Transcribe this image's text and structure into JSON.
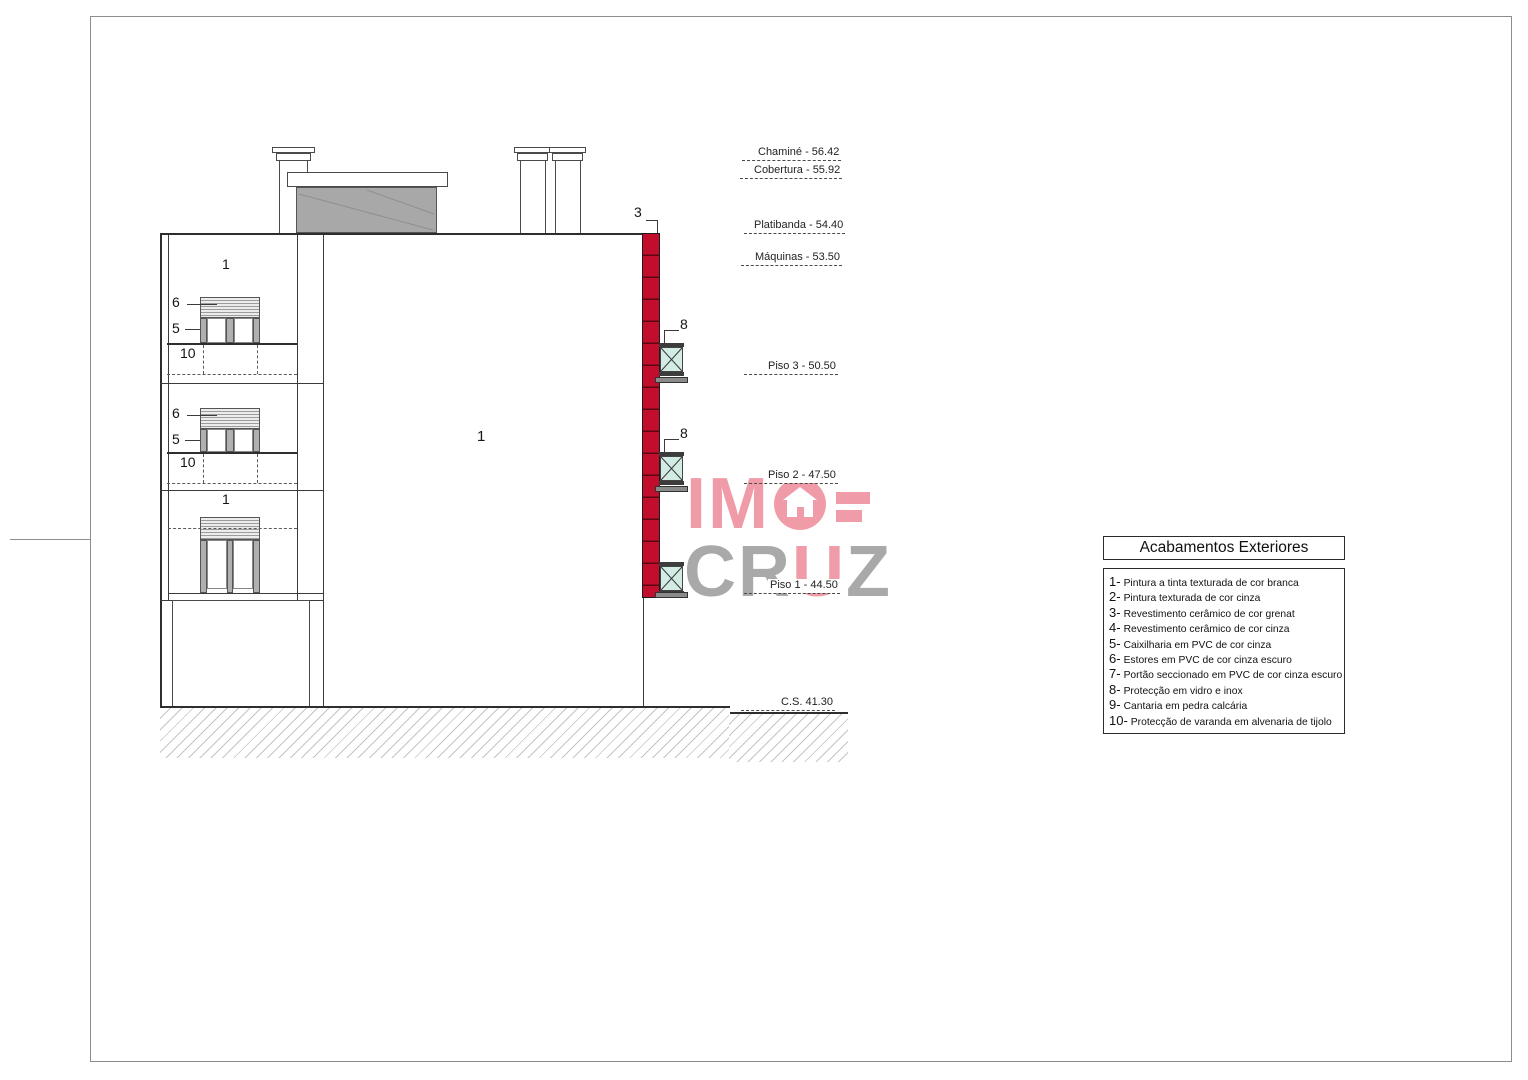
{
  "callouts": {
    "wall_white": "1",
    "ceramic": "3",
    "frame": "5",
    "shutter": "6",
    "glass": "8",
    "parapet": "10"
  },
  "levels": [
    {
      "label": "Chaminé - 56.42"
    },
    {
      "label": "Cobertura - 55.92"
    },
    {
      "label": "Platibanda - 54.40"
    },
    {
      "label": "Máquinas - 53.50"
    },
    {
      "label": "Piso 3 - 50.50"
    },
    {
      "label": "Piso 2 - 47.50"
    },
    {
      "label": "Piso 1 - 44.50"
    },
    {
      "label": "C.S. 41.30"
    }
  ],
  "legend": {
    "title": "Acabamentos Exteriores",
    "items": [
      {
        "num": "1-",
        "text": "Pintura a tinta texturada de cor branca"
      },
      {
        "num": "2-",
        "text": "Pintura texturada de cor cinza"
      },
      {
        "num": "3-",
        "text": "Revestimento cerâmico de cor grenat"
      },
      {
        "num": "4-",
        "text": "Revestimento cerâmico de cor cinza"
      },
      {
        "num": "5-",
        "text": "Caixilharia em PVC de cor cinza"
      },
      {
        "num": "6-",
        "text": "Estores em PVC de cor cinza escuro"
      },
      {
        "num": "7-",
        "text": "Portão seccionado em PVC de cor cinza escuro"
      },
      {
        "num": "8-",
        "text": "Protecção em vidro e inox"
      },
      {
        "num": "9-",
        "text": "Cantaria em pedra calcária"
      },
      {
        "num": "10-",
        "text": "Protecção de varanda em alvenaria de tijolo"
      }
    ]
  },
  "watermark": {
    "im": "IM",
    "cr": "CR",
    "u": "U",
    "z": "Z"
  },
  "colors": {
    "ceramic_red": "#C20E2C",
    "logo_pink": "#F09CA8",
    "logo_gray": "#A9A9A9",
    "glass_green": "#D2EBE4",
    "machine_gray": "#A8A8A8"
  }
}
